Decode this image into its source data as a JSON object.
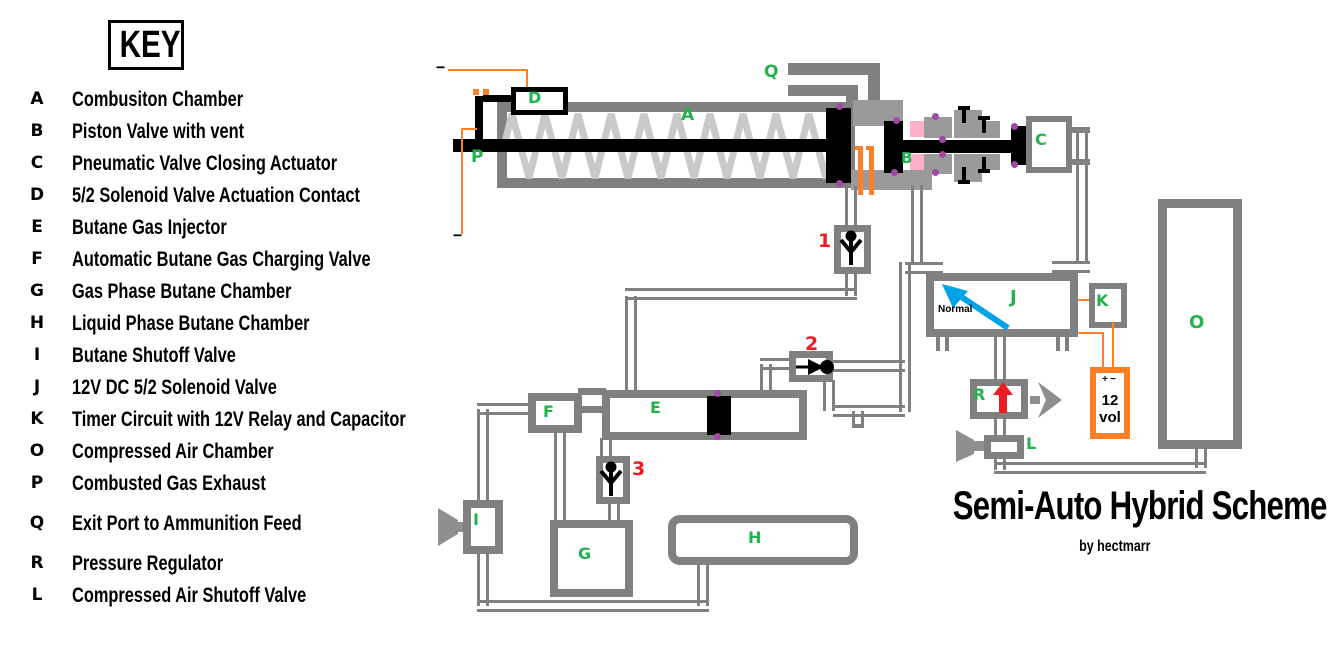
{
  "key": {
    "title": "KEY",
    "items": [
      {
        "letter": "A",
        "label": "Combusiton Chamber"
      },
      {
        "letter": "B",
        "label": "Piston Valve with vent"
      },
      {
        "letter": "C",
        "label": "Pneumatic Valve Closing Actuator"
      },
      {
        "letter": "D",
        "label": "5/2 Solenoid Valve Actuation Contact"
      },
      {
        "letter": "E",
        "label": "Butane Gas Injector"
      },
      {
        "letter": "F",
        "label": "Automatic Butane Gas Charging Valve"
      },
      {
        "letter": "G",
        "label": "Gas Phase Butane Chamber"
      },
      {
        "letter": "H",
        "label": "Liquid Phase Butane Chamber"
      },
      {
        "letter": "I",
        "label": "Butane Shutoff Valve"
      },
      {
        "letter": "J",
        "label": "12V DC 5/2 Solenoid Valve"
      },
      {
        "letter": "K",
        "label": "Timer Circuit with 12V Relay and Capacitor"
      },
      {
        "letter": "O",
        "label": "Compressed Air Chamber"
      },
      {
        "letter": "P",
        "label": "Combusted Gas Exhaust"
      },
      {
        "letter": "Q",
        "label": "Exit Port to Ammunition Feed"
      },
      {
        "letter": "R",
        "label": "Pressure Regulator"
      },
      {
        "letter": "L",
        "label": "Compressed Air Shutoff Valve"
      }
    ]
  },
  "title": {
    "main": "Semi-Auto Hybrid Scheme",
    "credit": "by hectmarr"
  },
  "diagram": {
    "labels": {
      "A": "A",
      "B": "B",
      "C": "C",
      "D": "D",
      "E": "E",
      "F": "F",
      "G": "G",
      "H": "H",
      "I": "I",
      "J": "J",
      "K": "K",
      "L": "L",
      "O": "O",
      "P": "P",
      "Q": "Q",
      "R": "R"
    },
    "valve_numbers": {
      "v1": "1",
      "v2": "2",
      "v3": "3"
    },
    "solenoid": {
      "normal_label": "Normal"
    },
    "battery": {
      "plus": "+",
      "minus": "−",
      "line1": "12",
      "line2": "vol"
    },
    "contacts": {
      "minus_top": "−",
      "minus_bottom": "−"
    },
    "colors": {
      "pipe_gray": "#808080",
      "spring_gray": "#c9c9c9",
      "label_green": "#22B14C",
      "number_red": "#ED1C24",
      "wire_orange": "#FF7F27",
      "junction_purple": "#A349A4",
      "seal_pink": "#FFAEC9",
      "arrow_blue": "#00A2E8"
    }
  }
}
